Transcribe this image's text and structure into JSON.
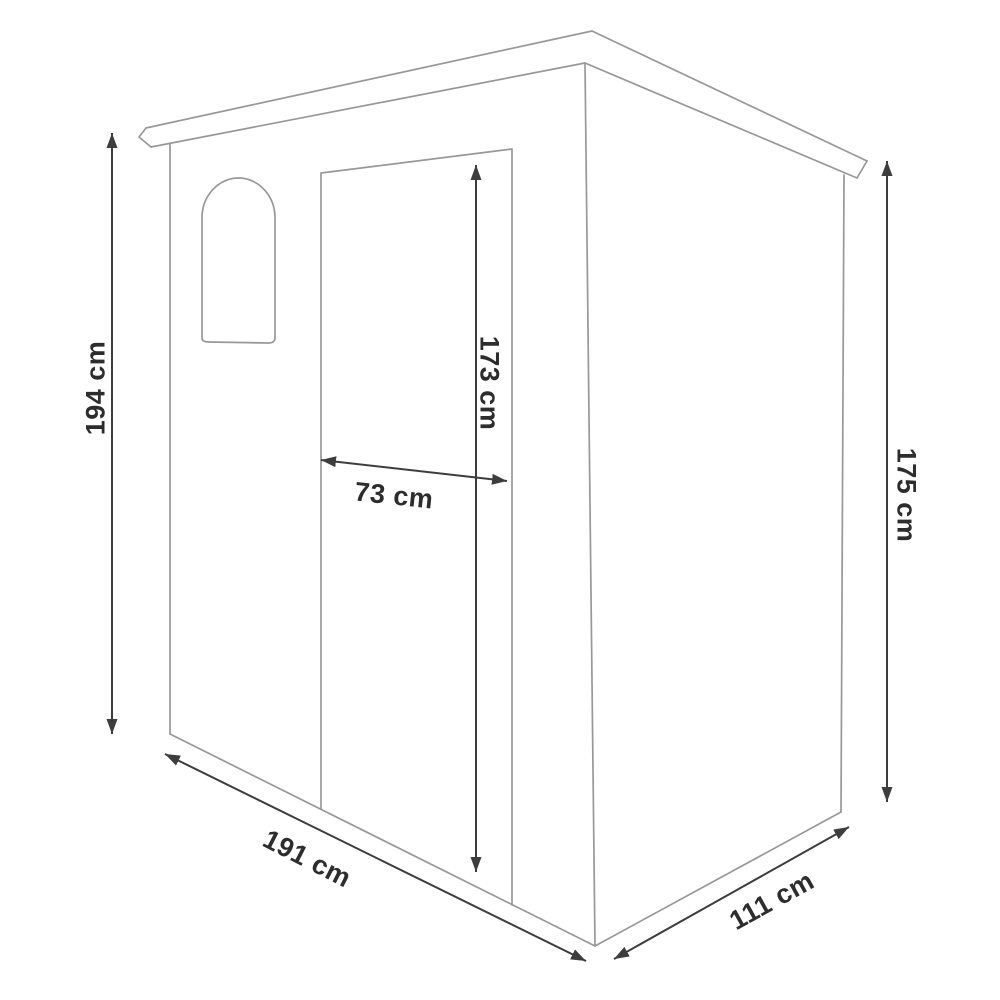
{
  "diagram": {
    "subject": "Garden shed dimension drawing",
    "dimensions": {
      "front_height": "194 cm",
      "door_height": "173 cm",
      "door_width": "73 cm",
      "rear_height": "175 cm",
      "width": "191 cm",
      "depth": "111 cm"
    },
    "colors": {
      "background": "#ffffff",
      "outline": "#969899",
      "dimension_line": "#3d3d3f",
      "label_text": "#2d2d2f"
    }
  }
}
